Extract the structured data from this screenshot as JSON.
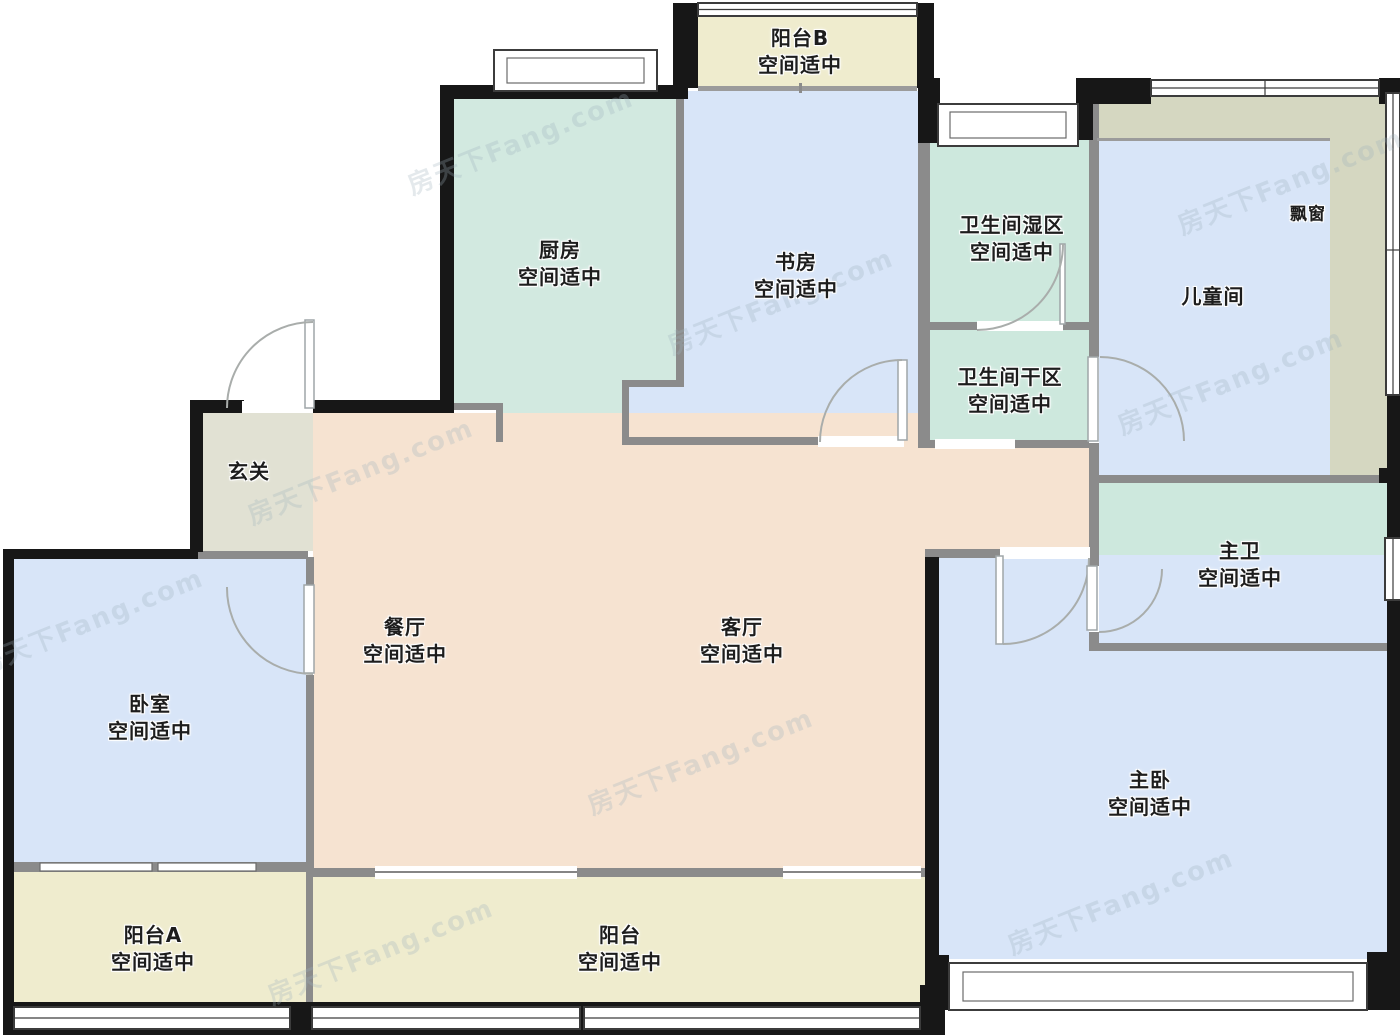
{
  "title": "户型图",
  "watermark": "房天下Fang.com",
  "colors": {
    "peach": "#f6e3d1",
    "teal": "#d2e9e0",
    "mint": "#cde8dd",
    "blue": "#d8e5f8",
    "cream": "#efecce",
    "entry": "#e1e1d3",
    "bay": "#d5d7c1",
    "wall_black": "#171717",
    "wall_grey": "#8b8b8b"
  },
  "rooms": [
    {
      "id": "balcony-b",
      "name": "阳台B",
      "status": "空间适中"
    },
    {
      "id": "kitchen",
      "name": "厨房",
      "status": "空间适中"
    },
    {
      "id": "study",
      "name": "书房",
      "status": "空间适中"
    },
    {
      "id": "bath-wet",
      "name": "卫生间湿区",
      "status": "空间适中"
    },
    {
      "id": "bath-dry",
      "name": "卫生间干区",
      "status": "空间适中"
    },
    {
      "id": "kids-room",
      "name": "儿童间",
      "status": ""
    },
    {
      "id": "bay-window",
      "name": "飘窗",
      "status": ""
    },
    {
      "id": "entry-hall",
      "name": "玄关",
      "status": ""
    },
    {
      "id": "dining-room",
      "name": "餐厅",
      "status": "空间适中"
    },
    {
      "id": "living-room",
      "name": "客厅",
      "status": "空间适中"
    },
    {
      "id": "master-bath",
      "name": "主卫",
      "status": "空间适中"
    },
    {
      "id": "bedroom",
      "name": "卧室",
      "status": "空间适中"
    },
    {
      "id": "master-bedroom",
      "name": "主卧",
      "status": "空间适中"
    },
    {
      "id": "balcony-a",
      "name": "阳台A",
      "status": "空间适中"
    },
    {
      "id": "balcony",
      "name": "阳台",
      "status": "空间适中"
    }
  ]
}
